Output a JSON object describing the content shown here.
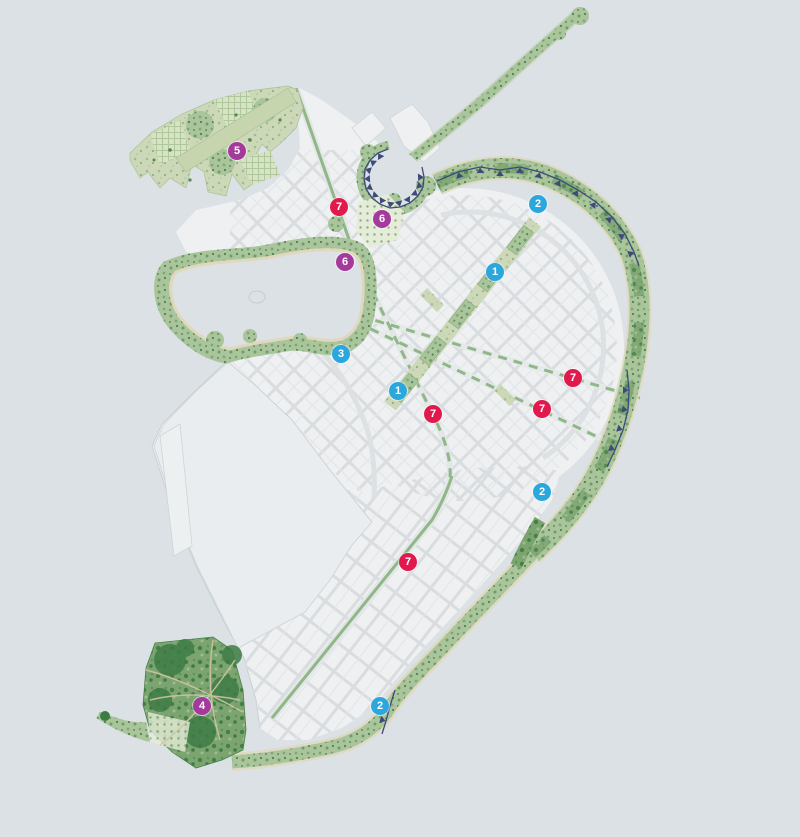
{
  "map": {
    "background_color": "#dbe1e4",
    "palette": {
      "water": "#dbe1e4",
      "city_block": "#eef0f1",
      "street": "#d9dde0",
      "street_major": "#dde1e3",
      "industrial": "#eaedef",
      "green_light": "#c9d7b3",
      "green_mid": "#a4c097",
      "green_dark": "#4c8551",
      "green_median": "#8fb787",
      "sand": "#ded5b8",
      "coast_line": "#3e4a7c",
      "marker_blue": "#2ba7dd",
      "marker_red": "#e11a4e",
      "marker_purple": "#a43a9c"
    },
    "markers": [
      {
        "label": "5",
        "color": "purple",
        "x": 237,
        "y": 151
      },
      {
        "label": "7",
        "color": "red",
        "x": 339,
        "y": 207
      },
      {
        "label": "6",
        "color": "purple",
        "x": 382,
        "y": 219
      },
      {
        "label": "2",
        "color": "blue",
        "x": 538,
        "y": 204
      },
      {
        "label": "6",
        "color": "purple",
        "x": 345,
        "y": 262
      },
      {
        "label": "1",
        "color": "blue",
        "x": 495,
        "y": 272
      },
      {
        "label": "3",
        "color": "blue",
        "x": 341,
        "y": 354
      },
      {
        "label": "1",
        "color": "blue",
        "x": 398,
        "y": 391
      },
      {
        "label": "7",
        "color": "red",
        "x": 433,
        "y": 414
      },
      {
        "label": "7",
        "color": "red",
        "x": 542,
        "y": 409
      },
      {
        "label": "7",
        "color": "red",
        "x": 573,
        "y": 378
      },
      {
        "label": "2",
        "color": "blue",
        "x": 542,
        "y": 492
      },
      {
        "label": "7",
        "color": "red",
        "x": 408,
        "y": 562
      },
      {
        "label": "4",
        "color": "purple",
        "x": 202,
        "y": 706
      },
      {
        "label": "2",
        "color": "blue",
        "x": 380,
        "y": 706
      }
    ]
  }
}
